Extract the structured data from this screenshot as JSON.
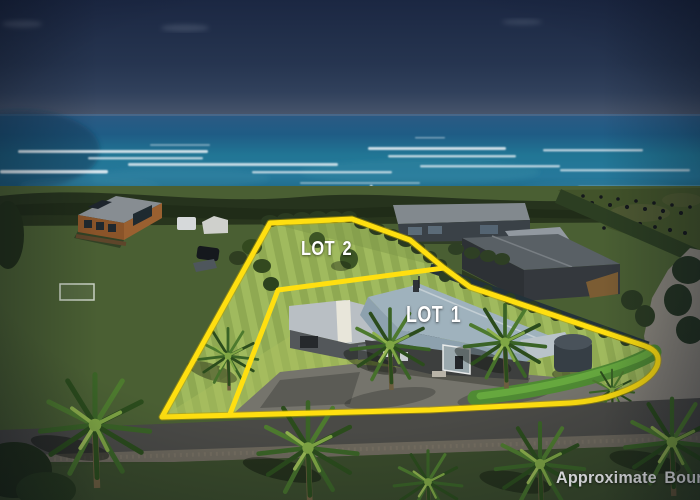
{
  "overlay": {
    "lot1_label": "LOT 1",
    "lot2_label": "LOT 2",
    "disclaimer": "Approximate Boundaries"
  },
  "palette": {
    "boundary_yellow": "#ffdf10",
    "label_white": "#ffffff",
    "sky_top": "#1b2742",
    "sky_horizon": "#49566c",
    "ocean_deep": "#2c5a84",
    "ocean_teal": "#21769a",
    "surf_foam": "#e9f1f6",
    "coastal_bush": "#26331d",
    "field_green": "#4a5f33",
    "lot_grass": "#97b058",
    "main_roof_blue_grey": "#9fb2bd",
    "shed_roof_grey": "#b9bfc4",
    "barn_grey": "#34383d",
    "cabin_brown": "#8a5429",
    "road_grey": "#4a4a46",
    "driveway_light": "#87837a",
    "palm_green": "#3a6326",
    "water_tank_grey": "#363e45"
  }
}
